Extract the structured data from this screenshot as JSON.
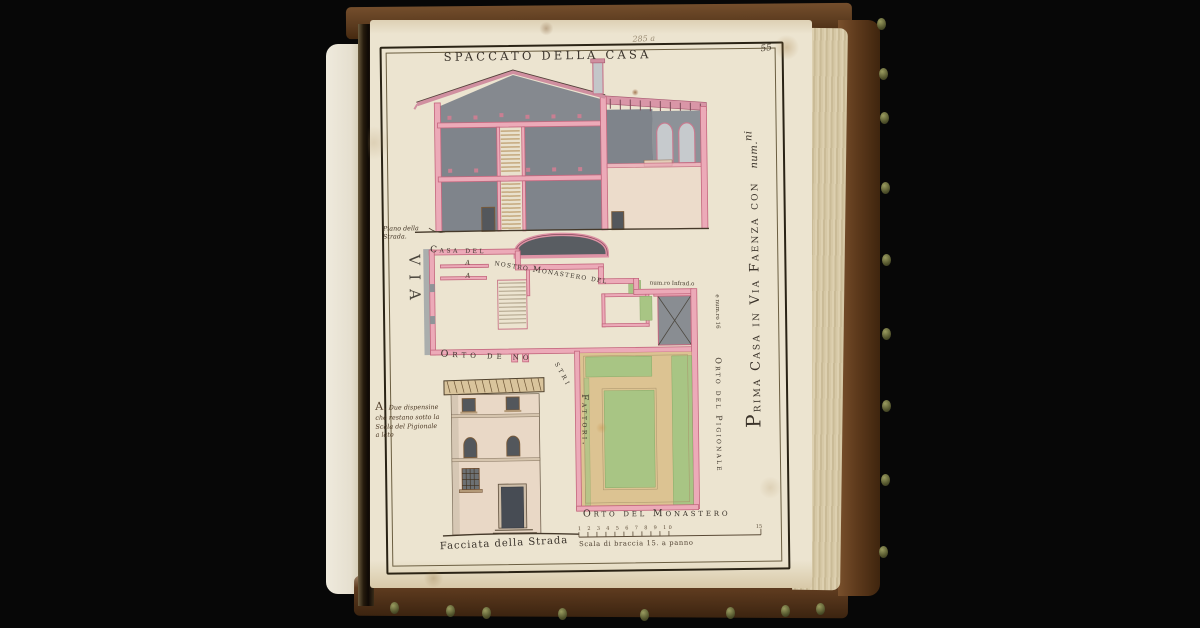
{
  "document": {
    "title": "SPACCATO DELLA CASA",
    "page_number": "55",
    "pencil_note": "285 a",
    "side_title": "Prima Casa in Via Faenza con",
    "side_title_suffix": "num.",
    "side_title_sup": "ni"
  },
  "section_labels": {
    "piano_line1": "Piano della",
    "piano_line2": "Strada."
  },
  "plan_labels": {
    "via": "VIA",
    "casa_del": "Casa del",
    "nostro_monastero": "nostro Monastero del",
    "num_infradetto": "num.ro Infrad.o",
    "e_numero": "e num.ro 16",
    "room_a_upper": "A",
    "room_a_lower": "A",
    "orto_fattori_start": "Orto de no",
    "orto_fattori_mid": "stri",
    "orto_fattori_end": "Fattori."
  },
  "note_a": {
    "line1": "A. Due dispensine",
    "line2": "che restano sotto la",
    "line3": "Scala del Pigionale",
    "line4": "a lato"
  },
  "garden_labels": {
    "orto_pigionale": "Orto del Pigionale",
    "orto_monastero": "Orto del Monastero"
  },
  "bottom_labels": {
    "facciata": "Facciata della Strada",
    "scala_caption": "Scala di braccia 15. a panno",
    "scale_tick_numbers": "1 2 3 4 5 6 7 8 9 10",
    "scale_end_number": "15"
  },
  "colors": {
    "black_bg": "#070707",
    "page_cream": "#ece4d0",
    "wall_pink": "#ecaab8",
    "wall_outline": "#c4677e",
    "wash_gray": "#7f848b",
    "dark_gray": "#53575c",
    "courtyard_gray": "#898d92",
    "garden_green": "#a8c584",
    "path_tan": "#dcc392",
    "stair_tan": "#b28c55",
    "ink": "#39322a",
    "brown_ink": "#4f3c28",
    "leather_brown": "#5e3a1e",
    "page_edge": "#d8cbac"
  }
}
